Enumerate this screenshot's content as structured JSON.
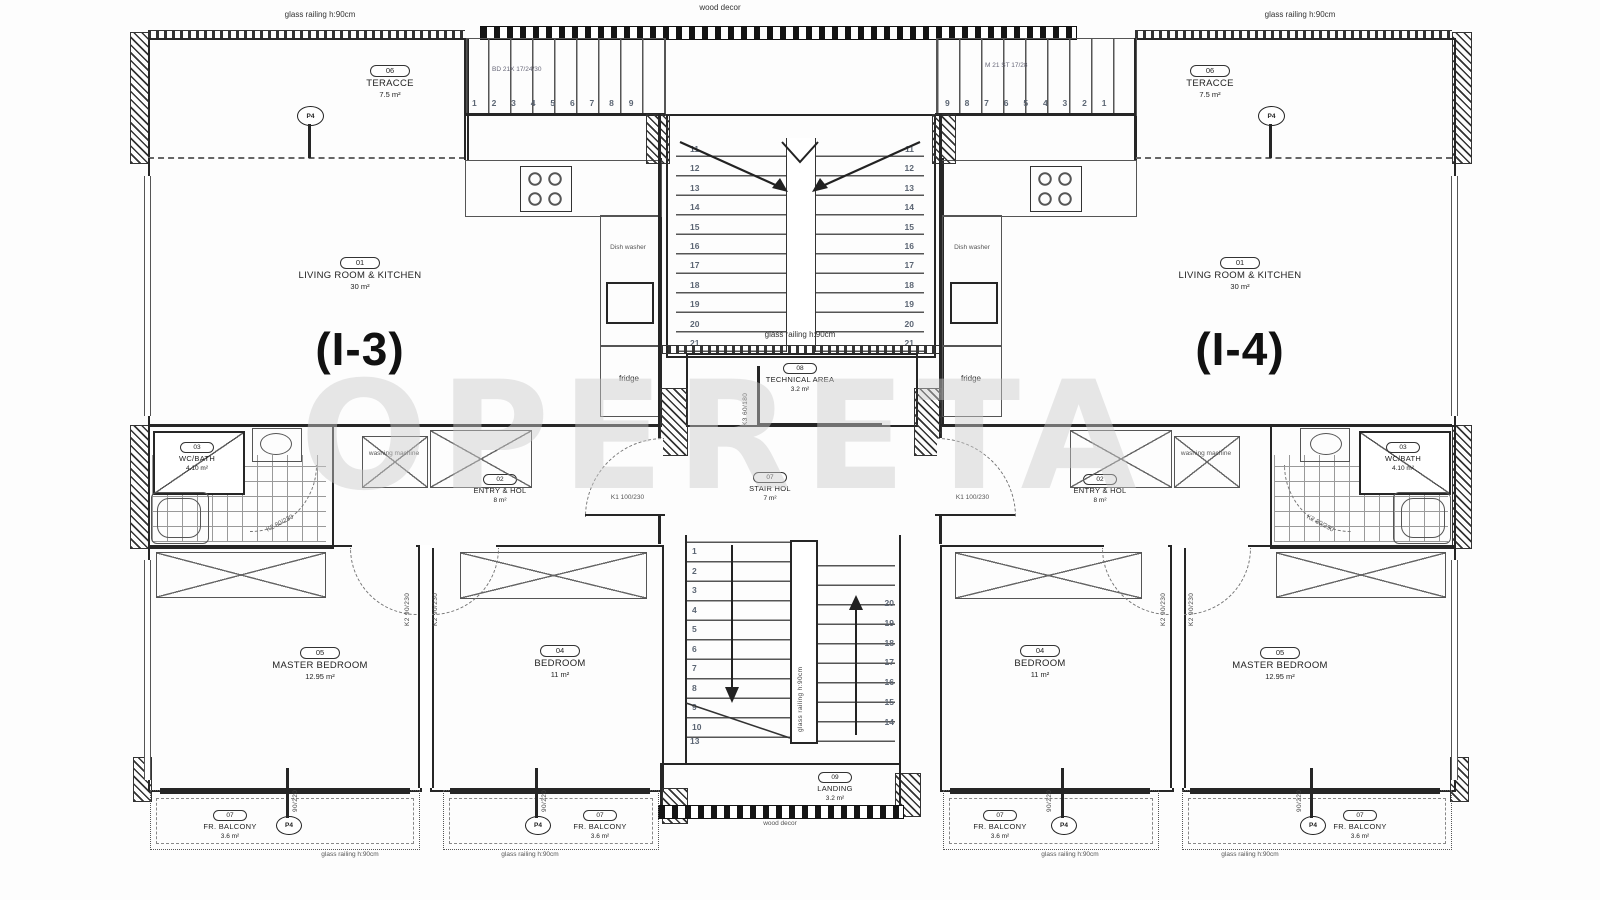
{
  "title": "Floor plan — units (I-3) and (I-4)",
  "watermark": "OPERETA",
  "units": {
    "left": "(I-3)",
    "right": "(I-4)"
  },
  "colors": {
    "line": "#262626",
    "stair_text": "#5b6573",
    "watermark": "#cccccc",
    "background": "#fdfdfd"
  },
  "labels": {
    "glass_railing": "glass railing h:90cm",
    "wood_decor": "wood decor",
    "fridge": "fridge",
    "dish_washer": "Dish washer",
    "washing_machine": "washing machine",
    "k1_door": "K1 100/230",
    "k2_bath_door": "K2 80/230",
    "k2_bed_door": "K2 90/230",
    "k3_door": "K3 60/180",
    "balcony_door": "90/220",
    "p4": "P4",
    "stair_spec_left": "BD 21X 17/24/30",
    "stair_spec_right": "M 21 ST 17/28"
  },
  "rooms": {
    "terrace": {
      "num": "06",
      "name": "TERACCE",
      "area": "7.5 m²"
    },
    "living": {
      "num": "01",
      "name": "LIVING ROOM & KITCHEN",
      "area": "30 m²"
    },
    "entry": {
      "num": "02",
      "name": "ENTRY & HOL",
      "area": "8 m²"
    },
    "wc": {
      "num": "03",
      "name": "WC/BATH",
      "area": "4.10 m²"
    },
    "bedroom": {
      "num": "04",
      "name": "BEDROOM",
      "area": "11 m²"
    },
    "master": {
      "num": "05",
      "name": "MASTER BEDROOM",
      "area": "12.95 m²"
    },
    "balcony": {
      "num": "07",
      "name": "FR. BALCONY",
      "area": "3.6 m²"
    },
    "stair_hol": {
      "num": "07",
      "name": "STAIR HOL",
      "area": "7 m²"
    },
    "technical": {
      "num": "08",
      "name": "TECHNICAL AREA",
      "area": "3.2 m²"
    },
    "landing": {
      "num": "09",
      "name": "LANDING",
      "area": "3.2 m²"
    }
  },
  "stairs": {
    "top_left_numbers": "1 2 3 4 5 6 7 8 9",
    "top_right_numbers": "9 8 7 6 5 4 3 2 1",
    "upper_flight_numbers": "11\n12\n13\n14\n15\n16\n17\n18\n19\n20\n21",
    "lower_left_numbers": "1\n2\n3\n4\n5\n6\n7\n8\n9\n10",
    "lower_left_winder": "13",
    "lower_right_numbers": "20\n19\n18\n17\n16\n15\n14",
    "mid_rail_note": "glass railing h:90cm"
  }
}
